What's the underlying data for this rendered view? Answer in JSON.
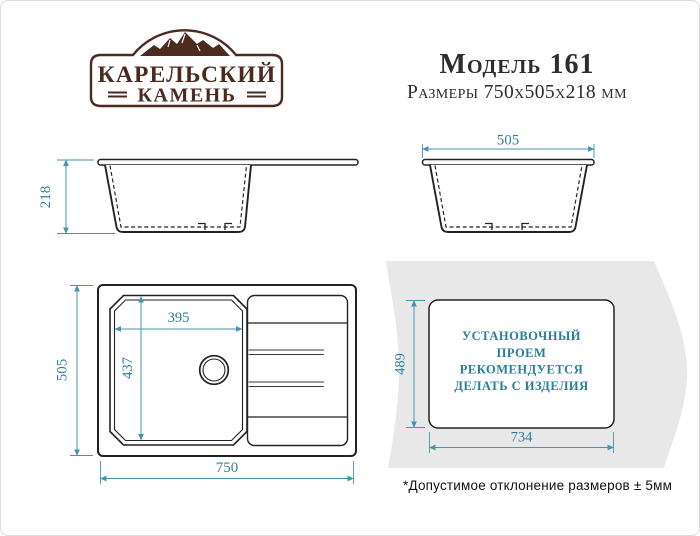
{
  "brand": {
    "name_line1": "КАРЕЛЬСКИЙ",
    "name_line2": "КАМЕНЬ"
  },
  "header": {
    "model": "Модель 161",
    "size_line": "Размеры 750х505х218 мм"
  },
  "views": {
    "front": {
      "height": "218"
    },
    "side": {
      "width": "505"
    },
    "top": {
      "overall_width": "750",
      "overall_depth": "505",
      "bowl_width": "395",
      "bowl_depth": "437"
    },
    "install": {
      "cutout_width": "734",
      "cutout_depth": "489",
      "note_line1": "УСТАНОВОЧНЫЙ",
      "note_line2": "ПРОЕМ",
      "note_line3": "РЕКОМЕНДУЕТСЯ",
      "note_line4": "ДЕЛАТЬ С ИЗДЕЛИЯ"
    }
  },
  "footnote": "*Допустимое отклонение размеров ± 5мм",
  "colors": {
    "accent_teal": "#2e7f9f",
    "dimension_line": "#4596ad",
    "drawing_line": "#222222",
    "brand_brown": "#4b2b20",
    "countertop_gray": "#e8e8e8"
  }
}
